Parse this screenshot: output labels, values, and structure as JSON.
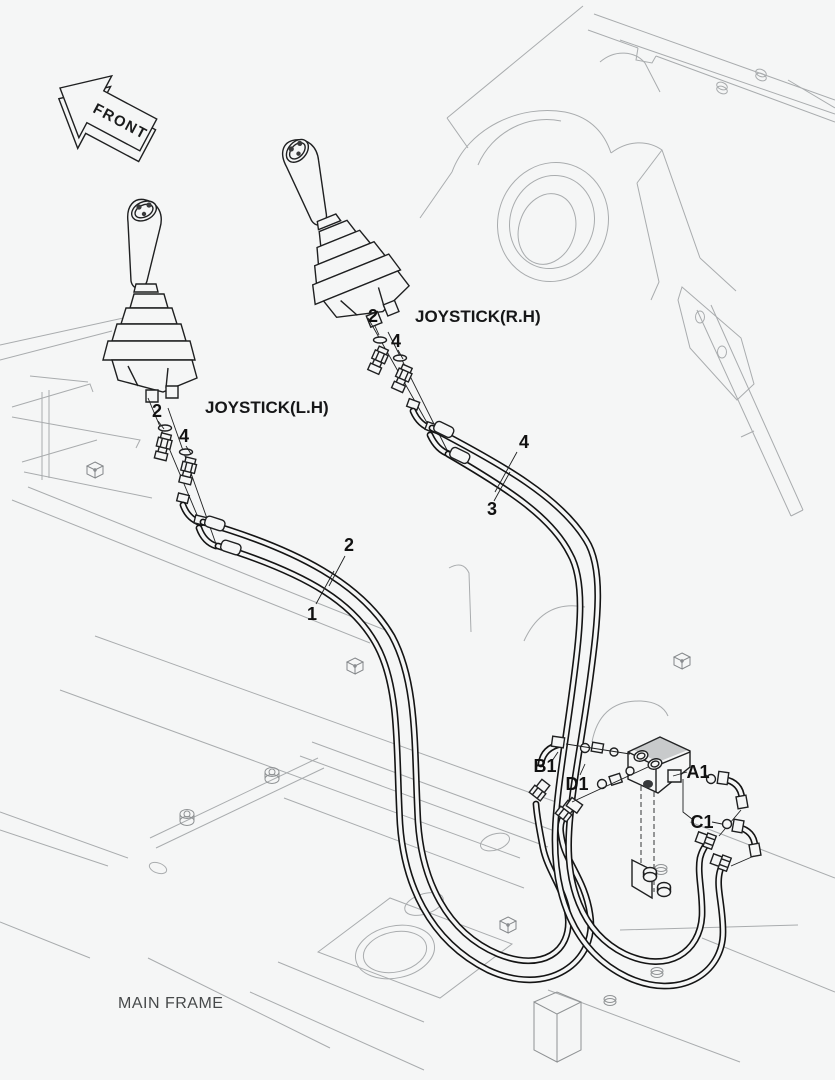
{
  "diagram_title": "Joystick pilot piping exploded diagram",
  "front_arrow": {
    "label": "FRONT"
  },
  "joysticks": {
    "left": {
      "label": "JOYSTICK(L.H)",
      "callout_seal": "2",
      "callout_fitting": "4"
    },
    "right": {
      "label": "JOYSTICK(R.H)",
      "callout_seal": "2",
      "callout_fitting": "4"
    }
  },
  "hose_callouts": {
    "c1": "1",
    "c2": "2",
    "c3": "3",
    "c4": "4"
  },
  "valve_ports": {
    "a1": "A1",
    "b1": "B1",
    "c1": "C1",
    "d1": "D1"
  },
  "frame": {
    "label": "MAIN FRAME"
  },
  "colors": {
    "background": "#f5f6f6",
    "frame_line": "#a9acae",
    "part_line": "#1f2021",
    "hose_line": "#141414",
    "label_text": "#161718",
    "frame_text": "#474a4b"
  }
}
